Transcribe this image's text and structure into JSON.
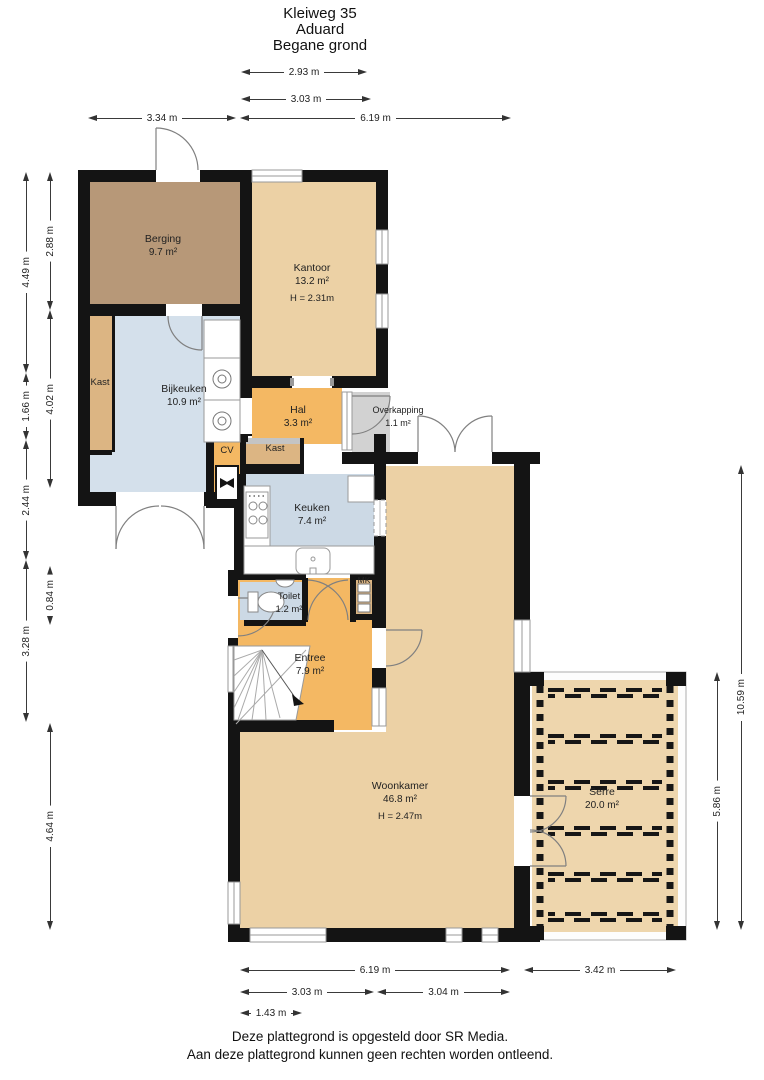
{
  "title": {
    "address": "Kleiweg 35",
    "city": "Aduard",
    "floor": "Begane grond"
  },
  "rooms": [
    {
      "id": "berging",
      "name": "Berging",
      "area": "9.7 m²"
    },
    {
      "id": "kantoor",
      "name": "Kantoor",
      "area": "13.2 m²",
      "height": "H = 2.31m"
    },
    {
      "id": "kast1",
      "name": "Kast"
    },
    {
      "id": "bijkeuken",
      "name": "Bijkeuken",
      "area": "10.9 m²"
    },
    {
      "id": "hal",
      "name": "Hal",
      "area": "3.3 m²"
    },
    {
      "id": "overkapping",
      "name": "Overkapping",
      "area": "1.1 m²"
    },
    {
      "id": "cv",
      "name": "CV"
    },
    {
      "id": "kast2",
      "name": "Kast"
    },
    {
      "id": "keuken",
      "name": "Keuken",
      "area": "7.4 m²"
    },
    {
      "id": "toilet",
      "name": "Toilet",
      "area": "1.2 m²"
    },
    {
      "id": "mk",
      "name": "MK"
    },
    {
      "id": "entree",
      "name": "Entree",
      "area": "7.9 m²"
    },
    {
      "id": "woonkamer",
      "name": "Woonkamer",
      "area": "46.8 m²",
      "height": "H = 2.47m"
    },
    {
      "id": "serre",
      "name": "Serre",
      "area": "20.0 m²"
    }
  ],
  "dimensions": {
    "items": [
      {
        "id": "top_293",
        "label": "2.93 m"
      },
      {
        "id": "top_303",
        "label": "3.03 m"
      },
      {
        "id": "top_334",
        "label": "3.34 m"
      },
      {
        "id": "top_619",
        "label": "6.19 m"
      },
      {
        "id": "l_449",
        "label": "4.49 m"
      },
      {
        "id": "l_166",
        "label": "1.66 m"
      },
      {
        "id": "l_244",
        "label": "2.44 m"
      },
      {
        "id": "l_328",
        "label": "3.28 m"
      },
      {
        "id": "l_288",
        "label": "2.88 m"
      },
      {
        "id": "l_402",
        "label": "4.02 m"
      },
      {
        "id": "l_084",
        "label": "0.84 m"
      },
      {
        "id": "l_464",
        "label": "4.64 m"
      },
      {
        "id": "r_1059",
        "label": "10.59 m"
      },
      {
        "id": "r_586",
        "label": "5.86 m"
      },
      {
        "id": "b_619",
        "label": "6.19 m"
      },
      {
        "id": "b_342",
        "label": "3.42 m"
      },
      {
        "id": "b_303",
        "label": "3.03 m"
      },
      {
        "id": "b_304",
        "label": "3.04 m"
      },
      {
        "id": "b_143",
        "label": "1.43 m"
      }
    ]
  },
  "footer": {
    "line1": "Deze plattegrond is opgesteld door SR Media.",
    "line2": "Aan deze plattegrond kunnen geen rechten worden ontleend."
  },
  "colors": {
    "wall": "#141414",
    "floor_tan": "#ecd1a5",
    "floor_brown": "#b79878",
    "floor_blue": "#d4e0eb",
    "floor_blue2": "#ccd9e5",
    "floor_orange": "#f4b863",
    "floor_kast": "#dcb583",
    "floor_serre": "#eed6ad",
    "overkapping": "#d2d2d2",
    "window_line": "#9a9a9a",
    "door_line": "#808080"
  }
}
